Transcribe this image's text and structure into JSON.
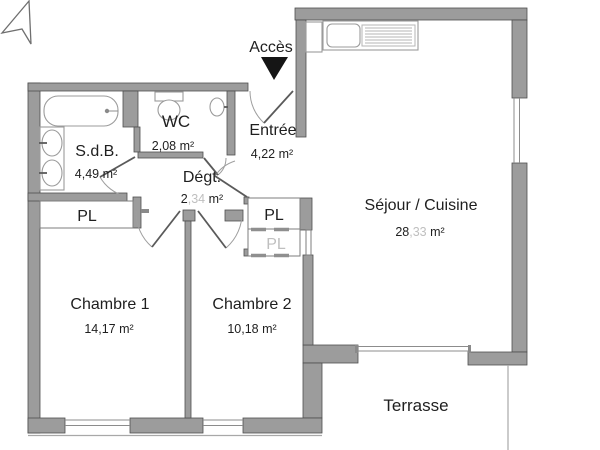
{
  "plan": {
    "access_label": "Accès",
    "rooms": {
      "sdb": {
        "name": "S.d.B.",
        "area": "4,49 m²"
      },
      "wc": {
        "name": "WC",
        "area": "2,08 m²"
      },
      "entree": {
        "name": "Entrée",
        "area": "4,22 m²"
      },
      "degagement": {
        "name": "Dégt.",
        "area_main": "2",
        "area_faded": ",34",
        "area_unit": " m²"
      },
      "sejour": {
        "name": "Séjour / Cuisine",
        "area_main": "28",
        "area_faded": ",33",
        "area_unit": " m²"
      },
      "chambre1": {
        "name": "Chambre 1",
        "area": "14,17 m²"
      },
      "chambre2": {
        "name": "Chambre 2",
        "area": "10,18 m²"
      },
      "terrasse": {
        "name": "Terrasse"
      }
    },
    "closets": {
      "chambre1_pl": "PL",
      "entree_pl": "PL",
      "chambre2_pl": "PL"
    },
    "colors": {
      "wall_fill": "#9c9c9c",
      "wall_stroke": "#4f4f4f",
      "thin_line": "#8c8c8c",
      "text": "#1f1f1f",
      "faded_text": "#bfbfbf",
      "access_arrow": "#151515"
    }
  }
}
